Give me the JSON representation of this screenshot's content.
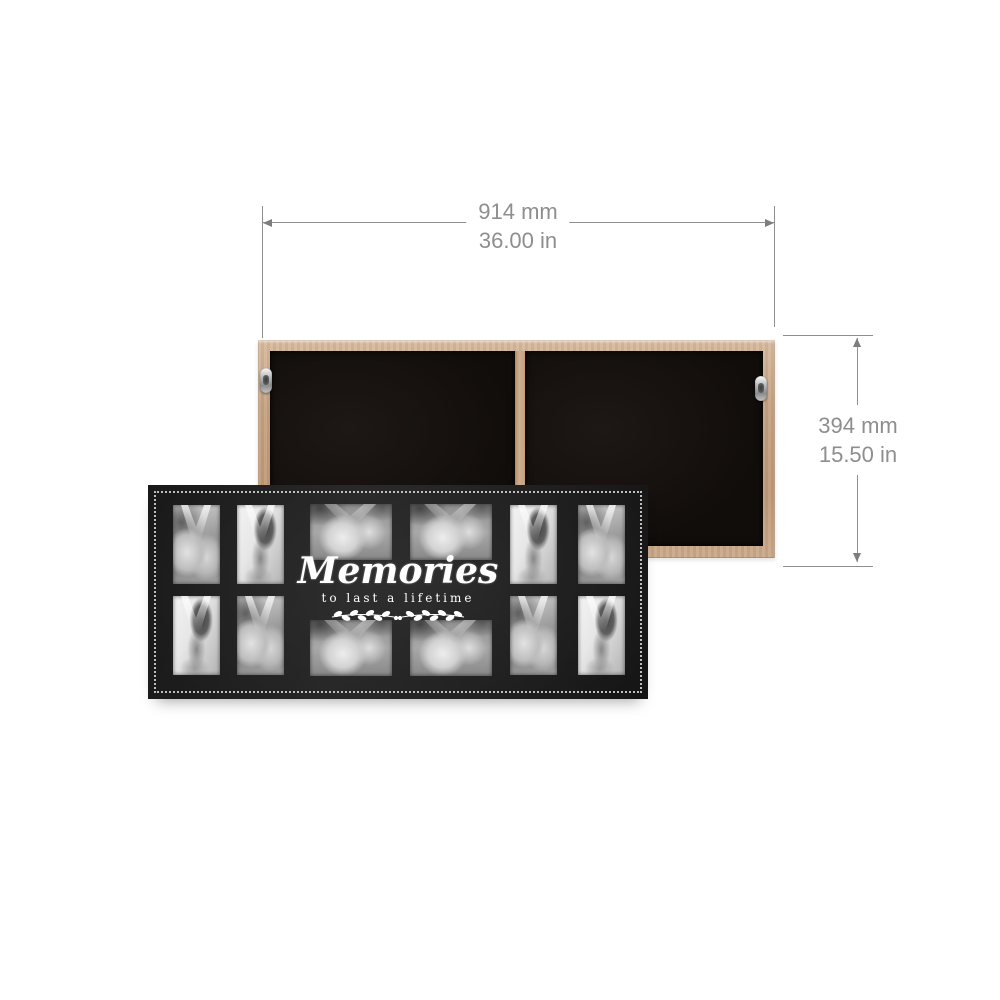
{
  "dimensions": {
    "width": {
      "metric": "914 mm",
      "imperial": "36.00 in"
    },
    "height": {
      "metric": "394 mm",
      "imperial": "15.50 in"
    }
  },
  "front_frame": {
    "caption_title": "Memories",
    "caption_subtitle": "to last a lifetime",
    "photo_count": 12,
    "rows": 2,
    "columns": 6,
    "portrait_slots": 8,
    "landscape_slots": 4
  },
  "back_frame": {
    "panel_count": 2,
    "hanger_count": 2
  },
  "colors": {
    "background": "#ffffff",
    "dimension_text": "#8e8e8e",
    "dimension_line": "#8f8f8f",
    "frame_black": "#1d1d1d",
    "wood": "#c6a283",
    "caption_text": "#ffffff",
    "bead_border": "#dbdbdb"
  }
}
